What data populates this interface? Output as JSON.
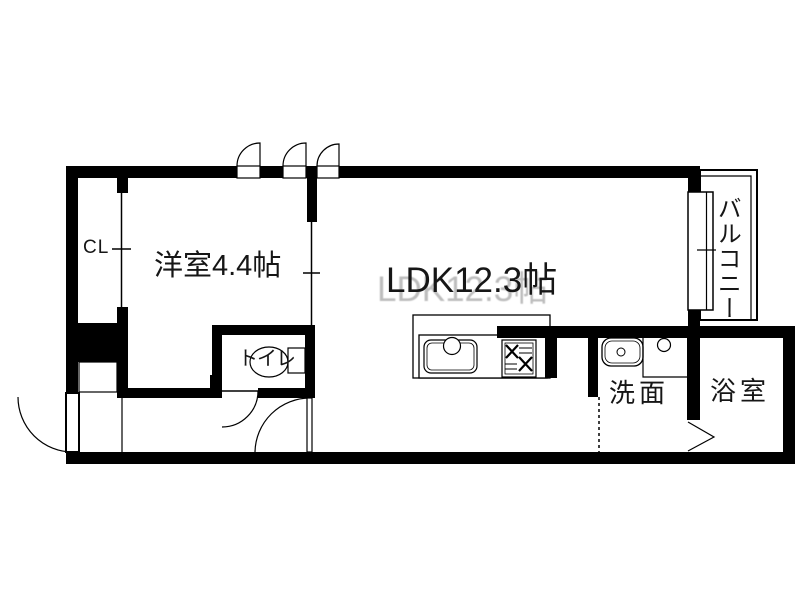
{
  "plan": {
    "type": "apartment-floorplan",
    "colors": {
      "wall": "#000000",
      "background": "#ffffff",
      "text": "#161616",
      "ghost_text": "#bdbdbd"
    },
    "rooms": {
      "closet": {
        "label": "CL"
      },
      "western_room": {
        "label": "洋室4.4帖"
      },
      "ldk": {
        "label": "LDK12.3帖"
      },
      "toilet": {
        "label": "トイレ"
      },
      "washroom": {
        "label": "洗面"
      },
      "bathroom": {
        "label": "浴室"
      },
      "balcony": {
        "label": "バルコニー"
      }
    }
  }
}
